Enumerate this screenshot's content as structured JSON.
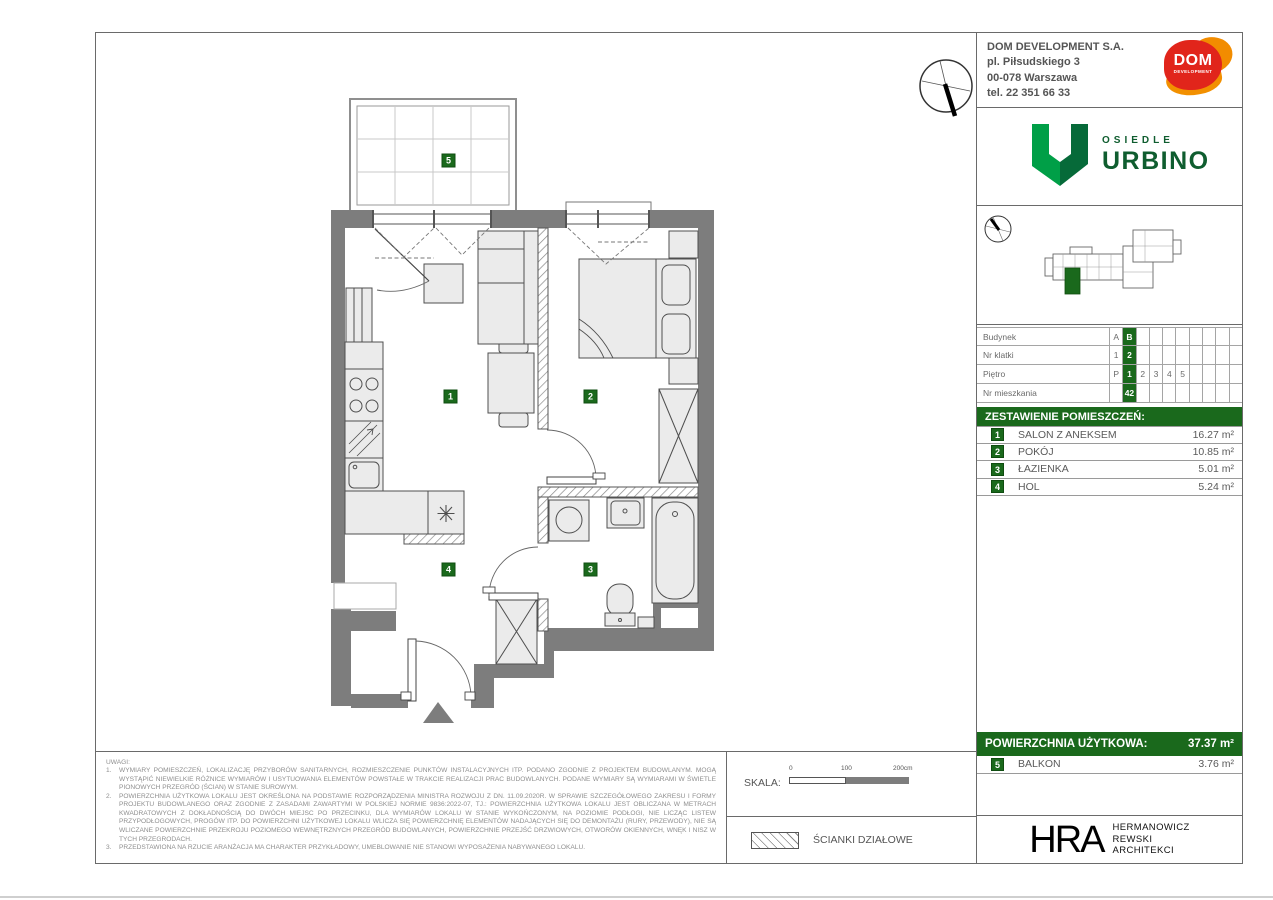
{
  "company": {
    "name": "DOM DEVELOPMENT S.A.",
    "address_line1": "pl. Piłsudskiego 3",
    "address_line2": "00-078 Warszawa",
    "phone": "tel. 22 351 66 33",
    "logo_text": "DOM",
    "logo_subtext": "DEVELOPMENT"
  },
  "project": {
    "label": "OSIEDLE",
    "name": "URBINO"
  },
  "unit_info": {
    "rows": [
      {
        "label": "Budynek",
        "cells": [
          "A",
          "B",
          "",
          "",
          "",
          "",
          "",
          "",
          "",
          ""
        ]
      },
      {
        "label": "Nr klatki",
        "cells": [
          "1",
          "2",
          "",
          "",
          "",
          "",
          "",
          "",
          "",
          ""
        ]
      },
      {
        "label": "Piętro",
        "cells": [
          "P",
          "1",
          "2",
          "3",
          "4",
          "5",
          "",
          "",
          "",
          ""
        ]
      },
      {
        "label": "Nr mieszkania",
        "cells": [
          "",
          "42",
          "",
          "",
          "",
          "",
          "",
          "",
          "",
          ""
        ]
      }
    ]
  },
  "rooms": {
    "title": "ZESTAWIENIE POMIESZCZEŃ:",
    "items": [
      {
        "num": "1",
        "name": "SALON Z ANEKSEM",
        "area": "16.27 m²"
      },
      {
        "num": "2",
        "name": "POKÓJ",
        "area": "10.85 m²"
      },
      {
        "num": "3",
        "name": "ŁAZIENKA",
        "area": "5.01 m²"
      },
      {
        "num": "4",
        "name": "HOL",
        "area": "5.24 m²"
      }
    ]
  },
  "summary": {
    "label": "POWIERZCHNIA UŻYTKOWA:",
    "value": "37.37 m²",
    "balcony": {
      "num": "5",
      "name": "BALKON",
      "area": "3.76 m²"
    }
  },
  "plan": {
    "badges": {
      "salon": "1",
      "pokoj": "2",
      "lazienka": "3",
      "hol": "4",
      "balkon": "5"
    }
  },
  "notes": {
    "title": "UWAGI:",
    "items": [
      {
        "num": "1.",
        "text": "WYMIARY POMIESZCZEŃ, LOKALIZACJĘ PRZYBORÓW SANITARNYCH, ROZMIESZCZENIE PUNKTÓW INSTALACYJNYCH ITP. PODANO ZGODNIE Z PROJEKTEM BUDOWLANYM. MOGĄ WYSTĄPIĆ NIEWIELKIE RÓŻNICE WYMIARÓW I USYTUOWANIA ELEMENTÓW POWSTAŁE W TRAKCIE REALIZACJI PRAC BUDOWLANYCH. PODANE WYMIARY SĄ WYMIARAMI W ŚWIETLE PIONOWYCH PRZEGRÓD (ŚCIAN) W STANIE SUROWYM."
      },
      {
        "num": "2.",
        "text": "POWIERZCHNIA UŻYTKOWA LOKALU JEST OKREŚLONA NA PODSTAWIE ROZPORZĄDZENIA MINISTRA ROZWOJU Z DN. 11.09.2020R. W SPRAWIE SZCZEGÓŁOWEGO ZAKRESU I FORMY PROJEKTU BUDOWLANEGO ORAZ ZGODNIE Z ZASADAMI ZAWARTYMI W POLSKIEJ NORMIE 9836:2022-07, TJ.: POWIERZCHNIA UŻYTKOWA LOKALU JEST OBLICZANA W METRACH KWADRATOWYCH Z DOKŁADNOŚCIĄ DO DWÓCH MIEJSC PO PRZECINKU, DLA WYMIARÓW LOKALU W STANIE WYKOŃCZONYM, NA POZIOMIE PODŁOGI, NIE LICZĄC LISTEW PRZYPODŁOGOWYCH, PROGÓW ITP. DO POWIERZCHNI UŻYTKOWEJ LOKALU WLICZA SIĘ POWIERZCHNIĘ ELEMENTÓW NADAJĄCYCH SIĘ DO DEMONTAŻU (RURY, PRZEWODY), NIE SĄ WLICZANE POWIERZCHNIE PRZEKROJU POZIOMEGO WEWNĘTRZNYCH PRZEGRÓD BUDOWLANYCH, POWIERZCHNIE PRZEJŚĆ DRZWIOWYCH, OTWORÓW OKIENNYCH, WNĘK I NISZ W TYCH PRZEGRODACH."
      },
      {
        "num": "3.",
        "text": "PRZEDSTAWIONA NA RZUCIE ARANŻACJA MA CHARAKTER PRZYKŁADOWY, UMEBLOWANIE NIE STANOWI WYPOSAŻENIA NABYWANEGO LOKALU."
      }
    ]
  },
  "scale": {
    "label": "SKALA:",
    "tick0": "0",
    "tick100": "100",
    "tick200": "200cm"
  },
  "legend": {
    "partition_walls": "ŚCIANKI DZIAŁOWE"
  },
  "architect": {
    "abbr": "HRA",
    "line1": "HERMANOWICZ",
    "line2": "REWSKI",
    "line3": "ARCHITEKCI"
  },
  "colors": {
    "accent_green": "#1a691c",
    "urbino_light_green": "#009F47",
    "urbino_dark_green": "#066A39",
    "dom_red": "#E1251B",
    "dom_orange": "#F28C00",
    "wall_gray": "#7d7d7d"
  }
}
